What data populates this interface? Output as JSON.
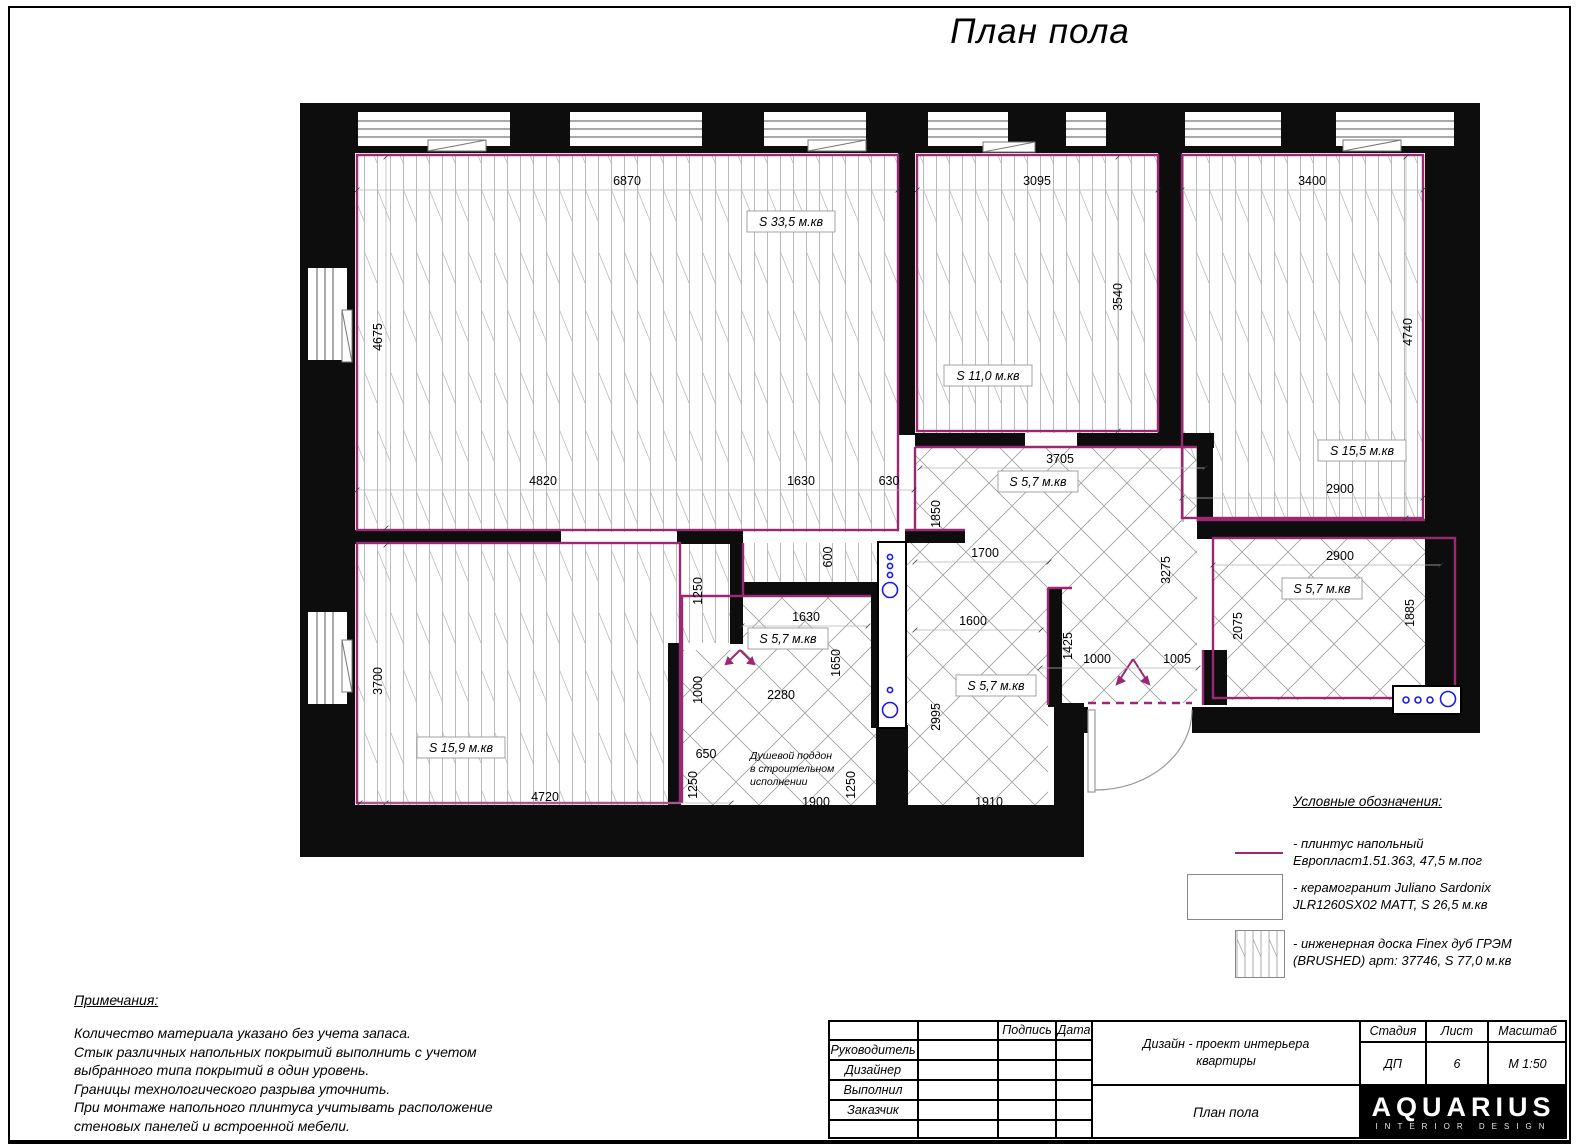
{
  "title": "План пола",
  "plan": {
    "dims_h": [
      "6870",
      "3095",
      "3400",
      "4820",
      "1630",
      "630",
      "3705",
      "1700",
      "1600",
      "1000",
      "1005",
      "2900",
      "2900",
      "1630",
      "2280",
      "650",
      "1900",
      "1910",
      "4720"
    ],
    "dims_v": [
      "4675",
      "3540",
      "4740",
      "1850",
      "600",
      "1250",
      "1650",
      "1000",
      "3700",
      "1250",
      "1250",
      "2995",
      "1425",
      "3275",
      "2075",
      "1885"
    ],
    "areas": [
      "S 33,5 м.кв",
      "S 11,0 м.кв",
      "S 15,5 м.кв",
      "S 5,7 м.кв",
      "S 5,7 м.кв",
      "S 5,7 м.кв",
      "S 5,7 м.кв",
      "S 15,9 м.кв"
    ],
    "shower_note": [
      "Душевой поддон",
      "в строительном",
      "исполнении"
    ]
  },
  "legend": {
    "title": "Условные обозначения:",
    "items": [
      {
        "line1": "- плинтус напольный",
        "line2": "Европласт1.51.363, 47,5 м.пог"
      },
      {
        "line1": "- керамогранит Juliano Sardonix",
        "line2": " JLR1260SX02 MATT, S 26,5 м.кв"
      },
      {
        "line1": "- инженерная доска Finex дуб ГРЭМ",
        "line2": "(BRUSHED) арт: 37746, S 77,0 м.кв"
      }
    ]
  },
  "notes": {
    "title": "Примечания:",
    "lines": [
      "Количество материала указано без учета запаса.",
      "Стык различных напольных покрытий выполнить с учетом",
      "выбранного типа покрытий в один уровень.",
      "Границы технологического разрыва уточнить.",
      "При монтаже напольного плинтуса учитывать расположение",
      "стеновых панелей и встроенной мебели."
    ]
  },
  "titleblock": {
    "col_signature": "Подпись",
    "col_date": "Дата",
    "rows": [
      "Руководитель",
      "Дизайнер",
      "Выполнил",
      "Заказчик"
    ],
    "project_line1": "Дизайн - проект интерьера",
    "project_line2": "квартиры",
    "sheet_title": "План пола",
    "stage_label": "Стадия",
    "stage_value": "ДП",
    "list_label": "Лист",
    "list_value": "6",
    "scale_label": "Масштаб",
    "scale_value": "М 1:50",
    "logo": "AQUARIUS",
    "logo_sub": "INTERIOR DESIGN"
  },
  "colors": {
    "plinth": "#9b2873",
    "wall": "#0d0d0d",
    "fixture": "#1a1aee"
  }
}
